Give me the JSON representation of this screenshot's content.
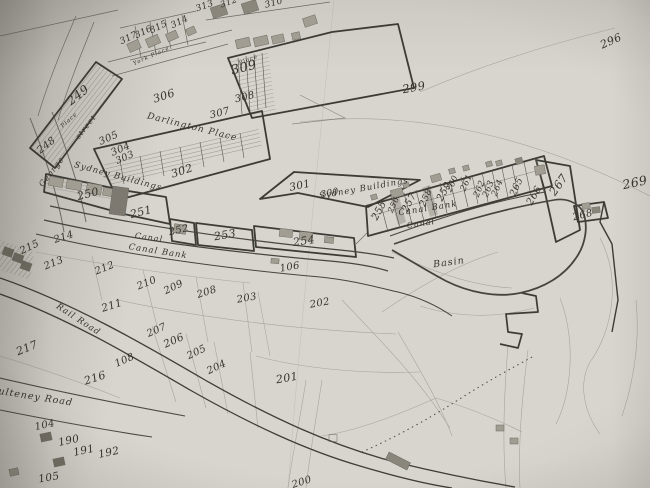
{
  "colors": {
    "paper": "#d8d5cf",
    "ink": "#35332c",
    "line_bold": "#3c3b35",
    "line_faint": "#6b6961",
    "pencil": "#96948b",
    "building_fill": "#a19d93",
    "building_dark": "#6e6a60"
  },
  "street_labels": [
    {
      "text": "York Place",
      "x": 152,
      "y": 57,
      "r": -24,
      "s": 5.5
    },
    {
      "text": "Place",
      "x": 249,
      "y": 61,
      "r": -22,
      "s": 5.5
    },
    {
      "text": "Place",
      "x": 70,
      "y": 121,
      "r": -42,
      "s": 5.5
    },
    {
      "text": "Darlington Place",
      "x": 192,
      "y": 128,
      "r": 14,
      "s": 9
    },
    {
      "text": "George",
      "x": 52,
      "y": 172,
      "r": -52,
      "s": 8
    },
    {
      "text": "street",
      "x": 86,
      "y": 127,
      "r": -52,
      "s": 7.5
    },
    {
      "text": "Sydney Buildings",
      "x": 118,
      "y": 177,
      "r": 15,
      "s": 8.5
    },
    {
      "text": "Sydney Buildings",
      "x": 364,
      "y": 189,
      "r": -10,
      "s": 8.5
    },
    {
      "text": "Canal",
      "x": 149,
      "y": 238,
      "r": 8,
      "s": 8
    },
    {
      "text": "Canal Bank",
      "x": 158,
      "y": 252,
      "r": 9,
      "s": 8.5
    },
    {
      "text": "Canal Bank",
      "x": 428,
      "y": 209,
      "r": -9,
      "s": 8.5
    },
    {
      "text": "Canal",
      "x": 421,
      "y": 224,
      "r": -9,
      "s": 8
    },
    {
      "text": "Basin",
      "x": 449,
      "y": 263,
      "r": -8,
      "s": 9.5
    },
    {
      "text": "Rail Road",
      "x": 78,
      "y": 320,
      "r": 33,
      "s": 8.5
    },
    {
      "text": "Pulteney Road",
      "x": 32,
      "y": 397,
      "r": 9,
      "s": 9.5
    }
  ],
  "plot_numbers": [
    {
      "text": "313",
      "x": 205,
      "y": 7,
      "r": -20,
      "s": 9
    },
    {
      "text": "312",
      "x": 229,
      "y": 3,
      "r": -20,
      "s": 8.5
    },
    {
      "text": "310",
      "x": 274,
      "y": 4,
      "r": -15,
      "s": 9
    },
    {
      "text": "317",
      "x": 129,
      "y": 39,
      "r": -26,
      "s": 9
    },
    {
      "text": "316",
      "x": 144,
      "y": 33,
      "r": -26,
      "s": 9
    },
    {
      "text": "315",
      "x": 159,
      "y": 28,
      "r": -26,
      "s": 9
    },
    {
      "text": "314",
      "x": 180,
      "y": 23,
      "r": -26,
      "s": 9
    },
    {
      "text": "306",
      "x": 164,
      "y": 96,
      "r": -18,
      "s": 11
    },
    {
      "text": "309",
      "x": 244,
      "y": 68,
      "r": -14,
      "s": 13
    },
    {
      "text": "308",
      "x": 245,
      "y": 98,
      "r": -14,
      "s": 10
    },
    {
      "text": "307",
      "x": 220,
      "y": 114,
      "r": -14,
      "s": 10
    },
    {
      "text": "299",
      "x": 414,
      "y": 88,
      "r": -10,
      "s": 11.5
    },
    {
      "text": "296",
      "x": 611,
      "y": 41,
      "r": -24,
      "s": 11
    },
    {
      "text": "249",
      "x": 78,
      "y": 95,
      "r": -38,
      "s": 12
    },
    {
      "text": "248",
      "x": 47,
      "y": 146,
      "r": -38,
      "s": 10
    },
    {
      "text": "305",
      "x": 109,
      "y": 139,
      "r": -24,
      "s": 10
    },
    {
      "text": "304",
      "x": 121,
      "y": 150,
      "r": -24,
      "s": 10
    },
    {
      "text": "303",
      "x": 125,
      "y": 158,
      "r": -24,
      "s": 9.5
    },
    {
      "text": "302",
      "x": 182,
      "y": 171,
      "r": -18,
      "s": 11
    },
    {
      "text": "301",
      "x": 300,
      "y": 186,
      "r": -12,
      "s": 10.5
    },
    {
      "text": "300",
      "x": 330,
      "y": 194,
      "r": -12,
      "s": 9
    },
    {
      "text": "250",
      "x": 88,
      "y": 194,
      "r": -14,
      "s": 11
    },
    {
      "text": "251",
      "x": 141,
      "y": 212,
      "r": -14,
      "s": 11
    },
    {
      "text": "252",
      "x": 179,
      "y": 231,
      "r": -12,
      "s": 10
    },
    {
      "text": "253",
      "x": 225,
      "y": 235,
      "r": -10,
      "s": 11
    },
    {
      "text": "254",
      "x": 304,
      "y": 241,
      "r": -8,
      "s": 11
    },
    {
      "text": "106",
      "x": 290,
      "y": 268,
      "r": -10,
      "s": 10
    },
    {
      "text": "255",
      "x": 380,
      "y": 211,
      "r": -62,
      "s": 10
    },
    {
      "text": "256",
      "x": 394,
      "y": 205,
      "r": -65,
      "s": 8
    },
    {
      "text": "257",
      "x": 410,
      "y": 203,
      "r": -62,
      "s": 10
    },
    {
      "text": "258",
      "x": 427,
      "y": 198,
      "r": -66,
      "s": 9
    },
    {
      "text": "259",
      "x": 445,
      "y": 192,
      "r": -62,
      "s": 10
    },
    {
      "text": "260",
      "x": 453,
      "y": 184,
      "r": -66,
      "s": 8.5
    },
    {
      "text": "261",
      "x": 467,
      "y": 183,
      "r": -66,
      "s": 8.5
    },
    {
      "text": "262",
      "x": 480,
      "y": 189,
      "r": -68,
      "s": 8.5
    },
    {
      "text": "263",
      "x": 489,
      "y": 189,
      "r": -68,
      "s": 8.5
    },
    {
      "text": "264",
      "x": 498,
      "y": 188,
      "r": -68,
      "s": 8.5
    },
    {
      "text": "265",
      "x": 517,
      "y": 187,
      "r": -66,
      "s": 9.5
    },
    {
      "text": "266",
      "x": 535,
      "y": 196,
      "r": -60,
      "s": 10
    },
    {
      "text": "267",
      "x": 559,
      "y": 185,
      "r": -55,
      "s": 11.5
    },
    {
      "text": "268",
      "x": 583,
      "y": 216,
      "r": -14,
      "s": 10
    },
    {
      "text": "269",
      "x": 635,
      "y": 183,
      "r": -12,
      "s": 12.5
    },
    {
      "text": "215",
      "x": 30,
      "y": 248,
      "r": -26,
      "s": 10
    },
    {
      "text": "214",
      "x": 64,
      "y": 238,
      "r": -18,
      "s": 10
    },
    {
      "text": "213",
      "x": 54,
      "y": 264,
      "r": -22,
      "s": 10
    },
    {
      "text": "212",
      "x": 105,
      "y": 269,
      "r": -22,
      "s": 10
    },
    {
      "text": "211",
      "x": 112,
      "y": 306,
      "r": -18,
      "s": 10.5
    },
    {
      "text": "210",
      "x": 147,
      "y": 284,
      "r": -22,
      "s": 10
    },
    {
      "text": "209",
      "x": 174,
      "y": 288,
      "r": -26,
      "s": 10
    },
    {
      "text": "208",
      "x": 207,
      "y": 293,
      "r": -18,
      "s": 10
    },
    {
      "text": "203",
      "x": 247,
      "y": 299,
      "r": -10,
      "s": 10
    },
    {
      "text": "202",
      "x": 320,
      "y": 304,
      "r": -10,
      "s": 10
    },
    {
      "text": "217",
      "x": 27,
      "y": 348,
      "r": -22,
      "s": 11
    },
    {
      "text": "207",
      "x": 157,
      "y": 331,
      "r": -24,
      "s": 10
    },
    {
      "text": "206",
      "x": 174,
      "y": 341,
      "r": -24,
      "s": 10.5
    },
    {
      "text": "205",
      "x": 197,
      "y": 353,
      "r": -26,
      "s": 10
    },
    {
      "text": "204",
      "x": 217,
      "y": 368,
      "r": -26,
      "s": 10
    },
    {
      "text": "216",
      "x": 95,
      "y": 378,
      "r": -18,
      "s": 11
    },
    {
      "text": "108",
      "x": 125,
      "y": 361,
      "r": -24,
      "s": 10
    },
    {
      "text": "201",
      "x": 287,
      "y": 378,
      "r": -10,
      "s": 11
    },
    {
      "text": "104",
      "x": 45,
      "y": 426,
      "r": -12,
      "s": 10
    },
    {
      "text": "190",
      "x": 69,
      "y": 441,
      "r": -12,
      "s": 10.5
    },
    {
      "text": "191",
      "x": 84,
      "y": 451,
      "r": -12,
      "s": 10.5
    },
    {
      "text": "192",
      "x": 109,
      "y": 453,
      "r": -12,
      "s": 10.5
    },
    {
      "text": "105",
      "x": 49,
      "y": 478,
      "r": -10,
      "s": 10.5
    },
    {
      "text": "200",
      "x": 302,
      "y": 483,
      "r": -18,
      "s": 10
    }
  ]
}
